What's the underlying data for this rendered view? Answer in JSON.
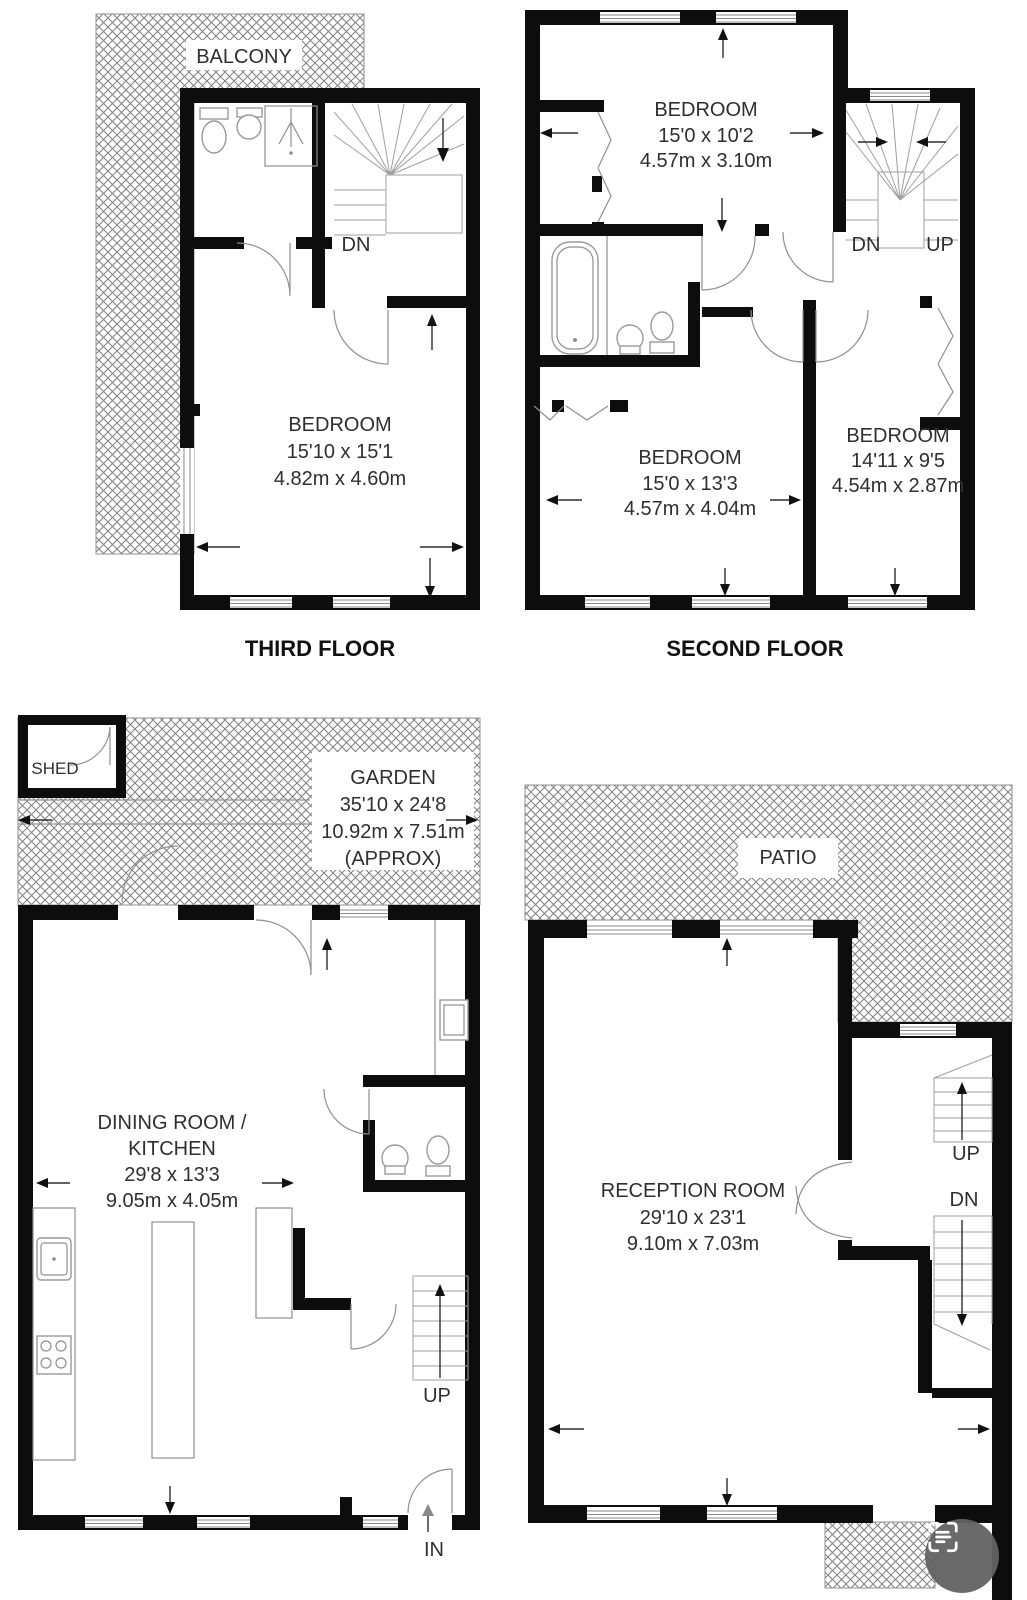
{
  "plans": {
    "third_floor": {
      "floor_label": "THIRD FLOOR",
      "balcony_label": "BALCONY",
      "stairs_down": "DN",
      "bedroom": {
        "name": "BEDROOM",
        "size_imperial": "15'10 x 15'1",
        "size_metric": "4.82m x 4.60m"
      }
    },
    "second_floor": {
      "floor_label": "SECOND FLOOR",
      "stairs_down": "DN",
      "stairs_up": "UP",
      "bedroom_top": {
        "name": "BEDROOM",
        "size_imperial": "15'0 x 10'2",
        "size_metric": "4.57m x 3.10m"
      },
      "bedroom_left": {
        "name": "BEDROOM",
        "size_imperial": "15'0 x 13'3",
        "size_metric": "4.57m x 4.04m"
      },
      "bedroom_right": {
        "name": "BEDROOM",
        "size_imperial": "14'11 x 9'5",
        "size_metric": "4.54m x 2.87m"
      }
    },
    "ground_floor": {
      "shed_label": "SHED",
      "garden": {
        "name": "GARDEN",
        "size_imperial": "35'10 x 24'8",
        "size_metric": "10.92m x 7.51m",
        "approx": "(APPROX)"
      },
      "dining_kitchen": {
        "name_line1": "DINING ROOM /",
        "name_line2": "KITCHEN",
        "size_imperial": "29'8 x 13'3",
        "size_metric": "9.05m x 4.05m"
      },
      "stairs_up": "UP",
      "entrance": "IN"
    },
    "first_floor": {
      "patio_label": "PATIO",
      "reception": {
        "name": "RECEPTION ROOM",
        "size_imperial": "29'10 x 23'1",
        "size_metric": "9.10m x 7.03m"
      },
      "stairs_up": "UP",
      "stairs_down": "DN"
    }
  },
  "colors": {
    "wall": "#0d0d0d",
    "hatch_line": "#808080",
    "text": "#2f2f2f",
    "fab_background": "#626262"
  }
}
